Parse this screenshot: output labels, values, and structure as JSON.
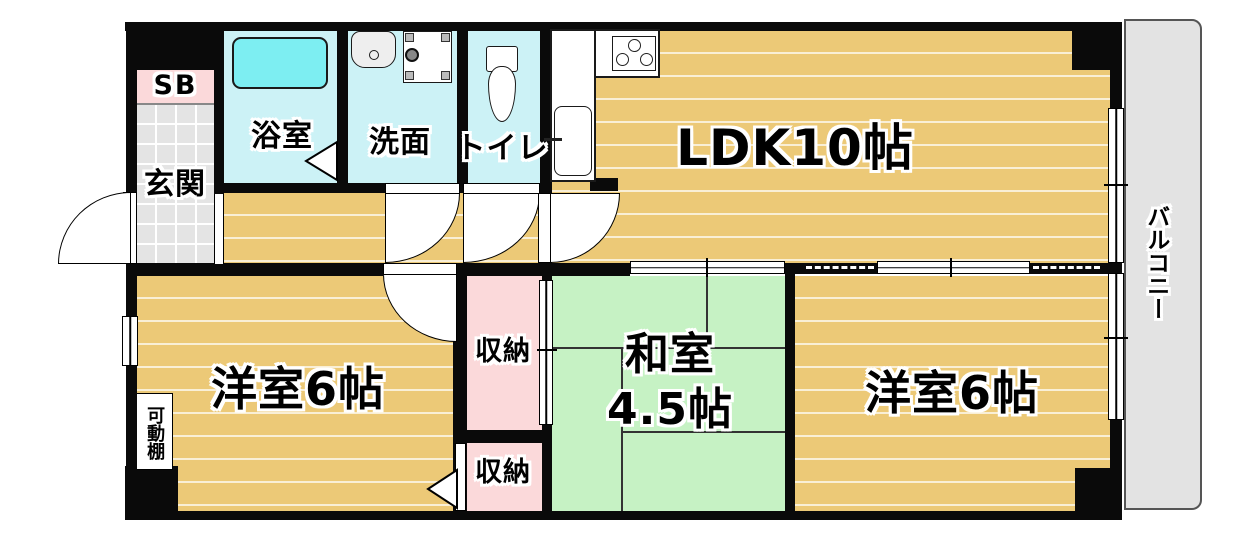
{
  "plan_title": "apartment-floor-plan",
  "labels": {
    "ldk": "LDK10帖",
    "western_room_left": "洋室6帖",
    "western_room_right": "洋室6帖",
    "japanese_room_line1": "和室",
    "japanese_room_line2": "4.5帖",
    "bathroom": "浴室",
    "washroom": "洗面",
    "toilet": "トイレ",
    "entrance": "玄関",
    "shoe_box": "SB",
    "storage_top": "収納",
    "storage_bottom": "収納",
    "balcony": "バルコニー",
    "movable_shelf": "可動棚"
  },
  "colors": {
    "wall": "#0a0a0a",
    "wood_floor": "#ecc977",
    "tatami_green": "#c6f2c4",
    "wet_area_cyan": "#ccf2f6",
    "bathtub_cyan": "#7deef2",
    "storage_pink": "#fbd9da",
    "entrance_tile_gray": "#e4e4e4",
    "balcony_gray": "#e3e3e3"
  }
}
